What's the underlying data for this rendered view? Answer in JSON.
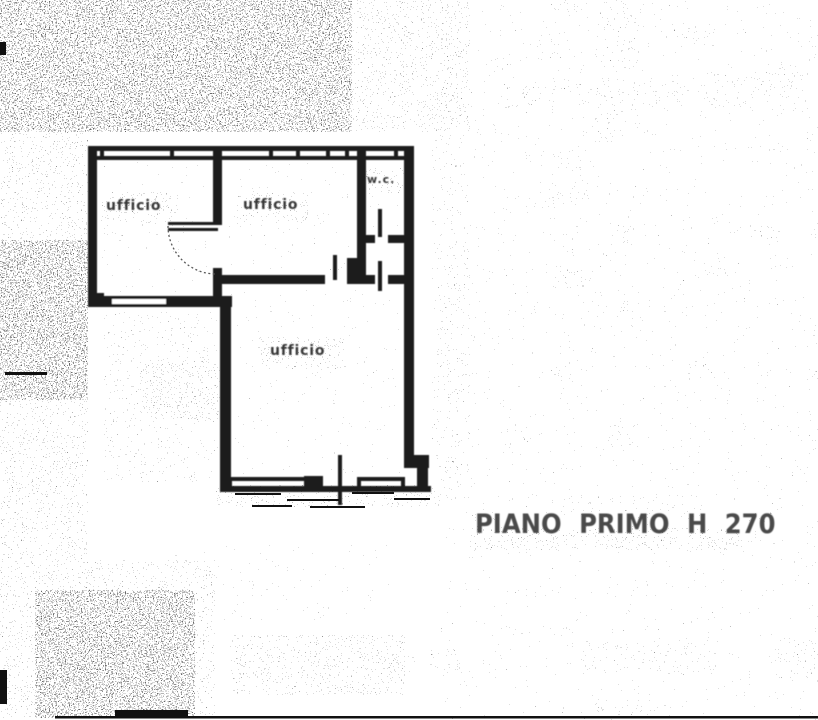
{
  "floorplan": {
    "rooms": [
      {
        "label": "ufficio"
      },
      {
        "label": "ufficio"
      },
      {
        "label": "ufficio"
      },
      {
        "label": "w.c."
      }
    ],
    "caption": "PIANO PRIMO H 270"
  },
  "colors": {
    "ink": "#1c1c1c",
    "label_text": "#383838",
    "caption_text": "#4a4a4a",
    "paper": "#ffffff"
  }
}
